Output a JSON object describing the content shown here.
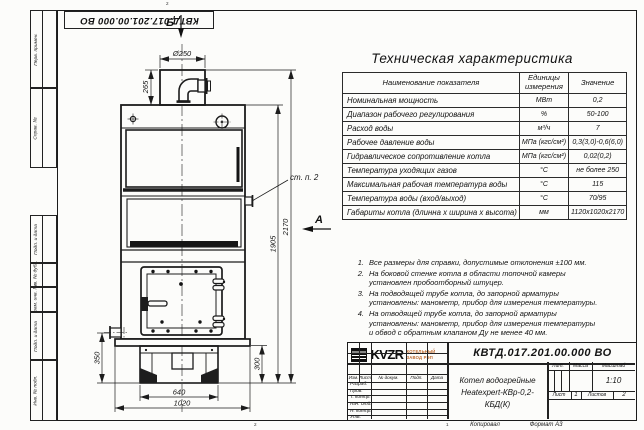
{
  "sheet": {
    "doc_number_top": "КВТД.017.201.00.000 ВО",
    "copied_label": "Копировал",
    "format_label": "Формат А3",
    "zone_top": "2",
    "zone_bottom_left": "2",
    "zone_bottom_right": "1"
  },
  "margin": [
    "Перв. примен.",
    "Справ. №",
    "Подп. и дата",
    "Инв. № дубл.",
    "Взам. инв. №",
    "Подп. и дата",
    "Инв. № подл."
  ],
  "drawing": {
    "view_b_label": "Б",
    "view_a_label": "А",
    "callout": "ст. п. 2",
    "dims": {
      "d250": "Ø250",
      "h265": "265",
      "h350": "350",
      "h300": "300",
      "w640": "640",
      "w1020": "1020",
      "h1905": "1905",
      "h2170": "2170"
    }
  },
  "spec": {
    "title": "Техническая характеристика",
    "headers": [
      "Наименование показателя",
      "Единицы измерения",
      "Значение"
    ],
    "rows": [
      [
        "Номинальная мощность",
        "МВт",
        "0,2"
      ],
      [
        "Диапазон рабочего регулирования",
        "%",
        "50-100"
      ],
      [
        "Расход воды",
        "м³/ч",
        "7"
      ],
      [
        "Рабочее давление воды",
        "МПа (кгс/см²)",
        "0,3(3,0)-0,6(6,0)"
      ],
      [
        "Гидравлическое сопротивление котла",
        "МПа (кгс/см²)",
        "0,02(0,2)"
      ],
      [
        "Температура уходящих газов",
        "°С",
        "не более 250"
      ],
      [
        "Максимальная рабочая температура воды",
        "°С",
        "115"
      ],
      [
        "Температура воды (вход/выход)",
        "°С",
        "70/95"
      ],
      [
        "Габариты котла (длинна х ширина х высота)",
        "мм",
        "1120х1020х2170"
      ]
    ]
  },
  "notes": [
    {
      "n": "1.",
      "text": "Все размеры для справки, допустимые отклонения ±100 мм."
    },
    {
      "n": "2.",
      "text": "На боковой стенке котла в области топочной камеры установлен пробоотборный штуцер."
    },
    {
      "n": "3.",
      "text": "На подводящей трубе котла, до запорной арматуры установлены: манометр, прибор для измерения температуры."
    },
    {
      "n": "4.",
      "text": "На отводящей трубе котла, до запорной арматуры установлены: манометр, прибор для измерения температуры и обвод с обратным клапаном Ду не менее 40 мм."
    }
  ],
  "title_block": {
    "doc_number": "КВТД.017.201.00.000 ВО",
    "product_name_line1": "Котел водогрейные",
    "product_name_line2": "Heatexpert-КВр-0,2- КБД(К)",
    "header_cols": [
      "Изм.",
      "Лист",
      "№ докум.",
      "Подп.",
      "Дата"
    ],
    "sig_rows": [
      "Разраб.",
      "Пров.",
      "Т. контр.",
      "Нач. отд.",
      "Н. контр.",
      "Утв."
    ],
    "lit_label": "Лит.",
    "mass_label": "Масса",
    "scale_label": "Масштаб",
    "scale_value": "1:10",
    "sheet_label": "Лист",
    "sheet_value": "1",
    "sheets_label": "Листов",
    "sheets_value": "2",
    "logo_word": "KVZR",
    "logo_caption_line1": "КОТЕЛЬНЫЙ",
    "logo_caption_line2": "ЗАВОД РЭП"
  }
}
